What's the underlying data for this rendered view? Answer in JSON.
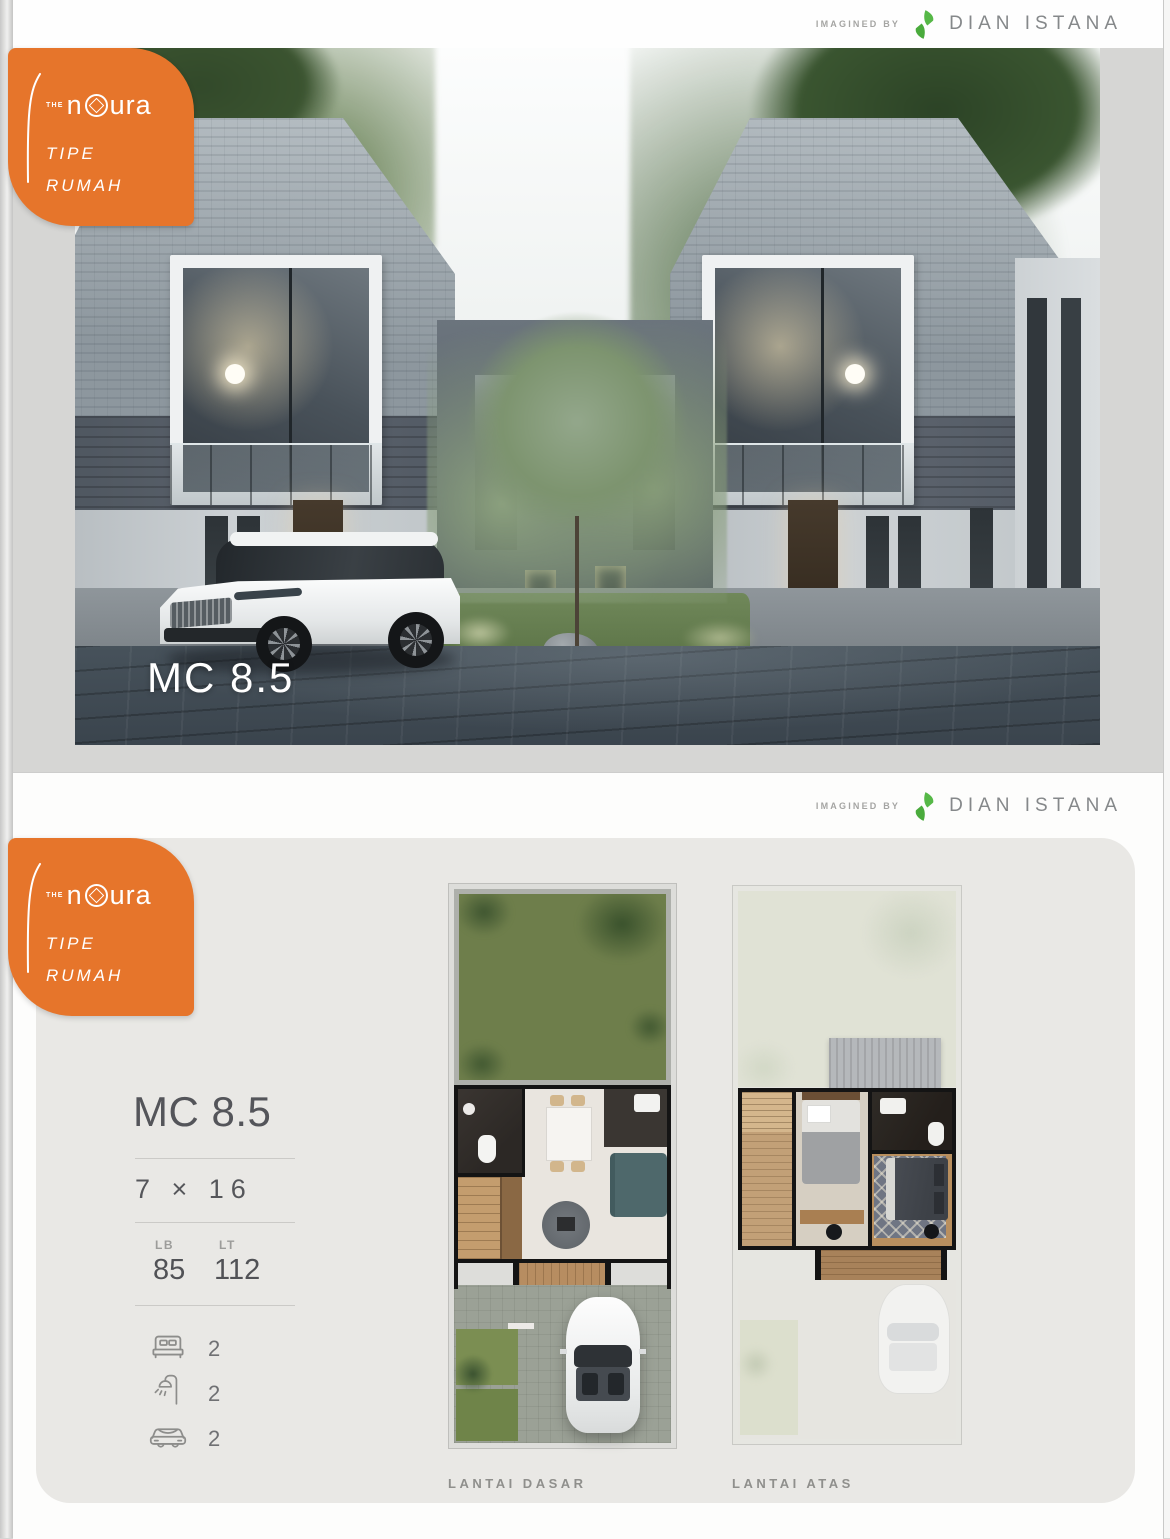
{
  "header": {
    "imagined_by": "IMAGINED BY",
    "brand": "DIAN ISTANA"
  },
  "badge": {
    "the": "THE",
    "name_n": "n",
    "name_o": "o",
    "name_rest": "ura",
    "tagline_line1": "TIPE",
    "tagline_line2": "RUMAH"
  },
  "page1": {
    "house_type_label": "MC 8.5"
  },
  "page2": {
    "title": "MC 8.5",
    "dimensions": "7 × 16",
    "specs": [
      {
        "label": "LB",
        "value": "85"
      },
      {
        "label": "LT",
        "value": "112"
      }
    ],
    "features": [
      {
        "icon": "bed-icon",
        "count": "2"
      },
      {
        "icon": "shower-icon",
        "count": "2"
      },
      {
        "icon": "car-icon",
        "count": "2"
      }
    ],
    "floor_plans": [
      {
        "label": "LANTAI DASAR"
      },
      {
        "label": "LANTAI ATAS"
      }
    ]
  },
  "colors": {
    "accent_orange": "#E6752B",
    "logo_green": "#56B847",
    "title_gray": "#54555A",
    "muted_gray": "#8F8F8C",
    "panel_gray": "#E9E8E5"
  }
}
